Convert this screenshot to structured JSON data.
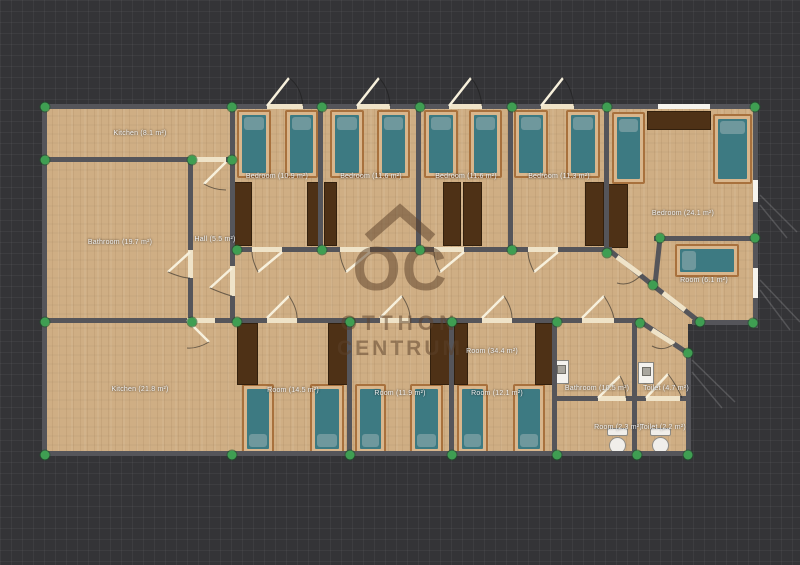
{
  "watermark": {
    "mark": "OC",
    "line1": "OTTHON",
    "line2": "CENTRUM"
  },
  "colors": {
    "background": "#343437",
    "wall": "#55555a",
    "floor": "#cfae84",
    "bed_mattress": "#3d7a82",
    "bed_pillow": "#6f989d",
    "bed_frame": "#d9b68c",
    "wardrobe": "#4e3116",
    "vertex_handle": "#3f9e52",
    "door_opening": "#efe3c8",
    "label_text": "#f2f2f2",
    "watermark_brown": "#5c422b"
  },
  "rooms": [
    {
      "id": "kitchen-top",
      "label": "Kitchen (8.1 m²)"
    },
    {
      "id": "bathroom-main",
      "label": "Bathroom (19.7 m²)"
    },
    {
      "id": "hall",
      "label": "Hall (5.5 m²)"
    },
    {
      "id": "bedroom-1",
      "label": "Bedroom (10.9 m²)"
    },
    {
      "id": "bedroom-2",
      "label": "Bedroom (11.6 m²)"
    },
    {
      "id": "bedroom-3",
      "label": "Bedroom (11.6 m²)"
    },
    {
      "id": "bedroom-4",
      "label": "Bedroom (11.3 m²)"
    },
    {
      "id": "bedroom-big",
      "label": "Bedroom (24.1 m²)"
    },
    {
      "id": "room-small",
      "label": "Room (6.1 m²)"
    },
    {
      "id": "corridor",
      "label": "Room (34.4 m²)"
    },
    {
      "id": "room-b1",
      "label": "Room (14.5 m²)"
    },
    {
      "id": "room-b2",
      "label": "Room (11.9 m²)"
    },
    {
      "id": "room-b3",
      "label": "Room (12.1 m²)"
    },
    {
      "id": "bathroom-2",
      "label": "Bathroom (10.5 m²)"
    },
    {
      "id": "toilet-1",
      "label": "Toilet (4.7 m²)"
    },
    {
      "id": "kitchen-2",
      "label": "Kitchen (21.8 m²)"
    },
    {
      "id": "room-tiny",
      "label": "Room (2.3 m²)"
    },
    {
      "id": "toilet-2",
      "label": "Toilet (2.2 m²)"
    }
  ]
}
